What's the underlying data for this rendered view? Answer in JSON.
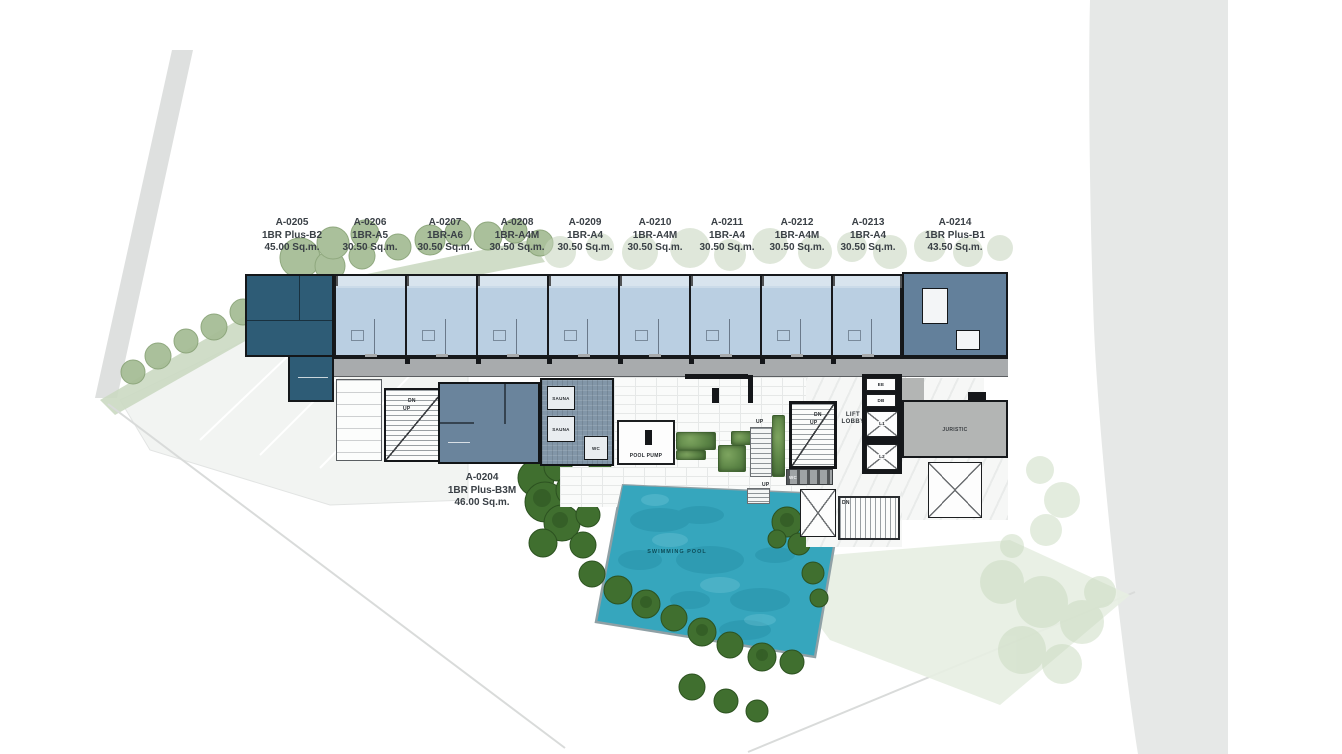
{
  "plan": {
    "units": [
      {
        "id": "A-0205",
        "type": "1BR Plus-B2",
        "area": "45.00 Sq.m."
      },
      {
        "id": "A-0206",
        "type": "1BR-A5",
        "area": "30.50 Sq.m."
      },
      {
        "id": "A-0207",
        "type": "1BR-A6",
        "area": "30.50 Sq.m."
      },
      {
        "id": "A-0208",
        "type": "1BR-A4M",
        "area": "30.50 Sq.m."
      },
      {
        "id": "A-0209",
        "type": "1BR-A4",
        "area": "30.50 Sq.m."
      },
      {
        "id": "A-0210",
        "type": "1BR-A4M",
        "area": "30.50 Sq.m."
      },
      {
        "id": "A-0211",
        "type": "1BR-A4",
        "area": "30.50 Sq.m."
      },
      {
        "id": "A-0212",
        "type": "1BR-A4M",
        "area": "30.50 Sq.m."
      },
      {
        "id": "A-0213",
        "type": "1BR-A4",
        "area": "30.50 Sq.m."
      },
      {
        "id": "A-0214",
        "type": "1BR Plus-B1",
        "area": "43.50 Sq.m."
      },
      {
        "id": "A-0204",
        "type": "1BR Plus-B3M",
        "area": "46.00 Sq.m."
      }
    ],
    "rooms": {
      "swimming_pool": "SWIMMING POOL",
      "pool_pump": "POOL PUMP",
      "lift_lobby_line1": "LIFT",
      "lift_lobby_line2": "LOBBY",
      "juristic": "JURISTIC",
      "sauna_upper": "SAUNA",
      "sauna_lower": "SAUNA",
      "wc_sauna": "WC",
      "wc_pool": "WC",
      "ee": "EE",
      "db": "DB",
      "lift1": "L1",
      "lift2": "L2"
    },
    "stairs": {
      "left_dn": "DN",
      "left_up": "UP",
      "right_dn": "DN",
      "right_up": "UP",
      "deck_up1": "UP",
      "deck_up2": "UP",
      "lower_dn": "DN"
    },
    "colors": {
      "dark_unit": "#2E5C76",
      "light_unit": "#BACFE2",
      "end_unit": "#63809B",
      "unit_0204": "#6A849C",
      "sauna": "#8296A8",
      "corridor": "#A8ABAD",
      "juristic": "#B3B5B4",
      "pool": "#36A6BD",
      "tree_dark": "#406F2F",
      "tree_light": "#A6BD96",
      "road": "#E6E8E7",
      "planter": "#5C8546"
    }
  }
}
